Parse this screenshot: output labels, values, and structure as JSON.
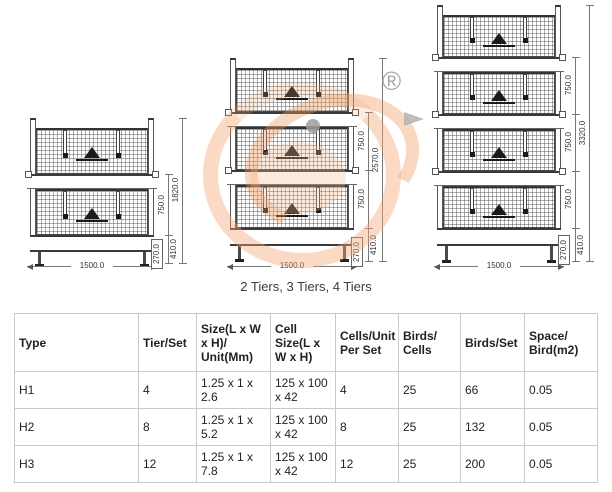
{
  "caption": "2 Tiers, 3 Tiers, 4 Tiers",
  "watermark": {
    "registered_symbol": "®",
    "ring_color": "#F3A873",
    "accent_gray": "#9C9C9C"
  },
  "drawings": {
    "two_tier": {
      "tier_height": "750.0",
      "total_height": "1820.0",
      "base_height": "410.0",
      "foot_height": "270.0",
      "width": "1500.0"
    },
    "three_tier": {
      "tier_height_upper": "750.0",
      "tier_height_lower": "750.0",
      "total_height": "2570.0",
      "base_height": "410.0",
      "foot_height": "270.0",
      "width": "1500.0"
    },
    "four_tier": {
      "tier_height_1": "750.0",
      "tier_height_2": "750.0",
      "tier_height_3": "750.0",
      "total_height": "3320.0",
      "base_height": "410.0",
      "foot_height": "270.0",
      "width": "1500.0"
    }
  },
  "table": {
    "headers": [
      "Type",
      "Tier/Set",
      "Size(L x W x H)/ Unit(Mm)",
      "Cell Size(L x W x H)",
      "Cells/Unit Per Set",
      "Birds/ Cells",
      "Birds/Set",
      "Space/ Bird(m2)"
    ],
    "rows": [
      {
        "cells": [
          "H1",
          "4",
          "1.25 x 1 x 2.6",
          "125 x 100 x 42",
          "4",
          "25",
          "66",
          "0.05"
        ]
      },
      {
        "cells": [
          "H2",
          "8",
          "1.25 x 1 x 5.2",
          "125 x 100 x 42",
          "8",
          "25",
          "132",
          "0.05"
        ]
      },
      {
        "cells": [
          "H3",
          "12",
          "1.25 x 1 x 7.8",
          "125 x 100 x 42",
          "12",
          "25",
          "200",
          "0.05"
        ]
      }
    ]
  }
}
